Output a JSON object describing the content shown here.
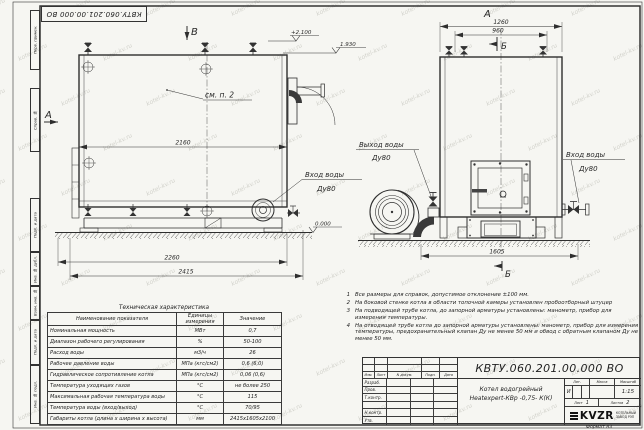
{
  "watermark": {
    "text": "kotel-kv.ru"
  },
  "frame": {
    "doc_box": "КВТУ.060.201.00.000  ВО",
    "left_stamps": [
      "Перв. примен.",
      "Справ. №",
      "Подп. и дата",
      "Инв. № дубл.",
      "Взам. инв. №",
      "Подп. и дата",
      "Инв. № подл."
    ],
    "format_label": "Формат  А3"
  },
  "drawing": {
    "section_a": "А",
    "section_b": "Б",
    "section_v": "В",
    "see_note": "см. п. 2",
    "elev_top": "+2.100",
    "elev_chimney": "1.930",
    "elev_ground": "0.000",
    "dim_2160": "2160",
    "dim_2260": "2260",
    "dim_2415": "2415",
    "dim_1260": "1260",
    "dim_960": "960",
    "dim_1605": "1605",
    "outlet_label": "Выход воды",
    "outlet_dn": "Ду80",
    "inlet_label": "Вход воды",
    "inlet_dn": "Ду80"
  },
  "tech_table": {
    "title": "Техническая характеристика",
    "headers": [
      "Наименование показателя",
      "Единицы измерения",
      "Значение"
    ],
    "rows": [
      [
        "Номинальная мощность",
        "МВт",
        "0,7"
      ],
      [
        "Диапазон рабочего регулирования",
        "%",
        "50-100"
      ],
      [
        "Расход воды",
        "м3/ч",
        "26"
      ],
      [
        "Рабочее давление воды",
        "МПа (кгс/см2)",
        "0,6 (6,0)"
      ],
      [
        "Гидравлическое сопротивление котла",
        "МПа (кгс/см2)",
        "0,06 (0,6)"
      ],
      [
        "Температура уходящих газов",
        "°С",
        "не более 250"
      ],
      [
        "Максимальная рабочая температура воды",
        "°С",
        "115"
      ],
      [
        "Температура воды (вход/выход)",
        "°С",
        "70/95"
      ],
      [
        "Габариты котла (длина х ширина х высота)",
        "мм",
        "2415х1605х2100"
      ]
    ]
  },
  "notes": [
    {
      "num": "1",
      "text": "Все размеры для справок, допустимое отклонение ±100 мм."
    },
    {
      "num": "2",
      "text": "На боковой стенке котла в области топочной камеры установлен пробоотборный штуцер"
    },
    {
      "num": "3",
      "text": "На  подводящей трубе котла, до запорной арматуры установлены: манометр, прибор для измерения температуры."
    },
    {
      "num": "4",
      "text": "На отводящей трубе котла до запорной арматуры установлены: манометр, прибор для измерения температуры, предохранительный клапан Ду не менее 50 мм и обвод с обратным клапаном Ду не менее 50 мм."
    }
  ],
  "title_block": {
    "doc_number": "КВТУ.060.201.00.000  ВО",
    "product_name_line1": "Котел водогрейный",
    "product_name_line2": "Heatexpert-КВр -0,75- К(К)",
    "col_headers": [
      "Изм.",
      "Лист",
      "N докум.",
      "Подп.",
      "Дата"
    ],
    "row_labels": [
      "Разраб.",
      "Пров.",
      "Т.контр.",
      "Н.контр.",
      "Утв."
    ],
    "lit_header": "Лит.",
    "mass_header": "Масса",
    "scale_header": "Масштаб",
    "lit_value": "И",
    "scale_value": "1:15",
    "sheet_label": "Лист",
    "sheet_value": "1",
    "sheets_label": "Листов",
    "sheets_value": "2",
    "logo_text": "KVZR",
    "company_line1": "КОТЕЛЬНЫЙ",
    "company_line2": "ЗАВОД РЭП"
  }
}
